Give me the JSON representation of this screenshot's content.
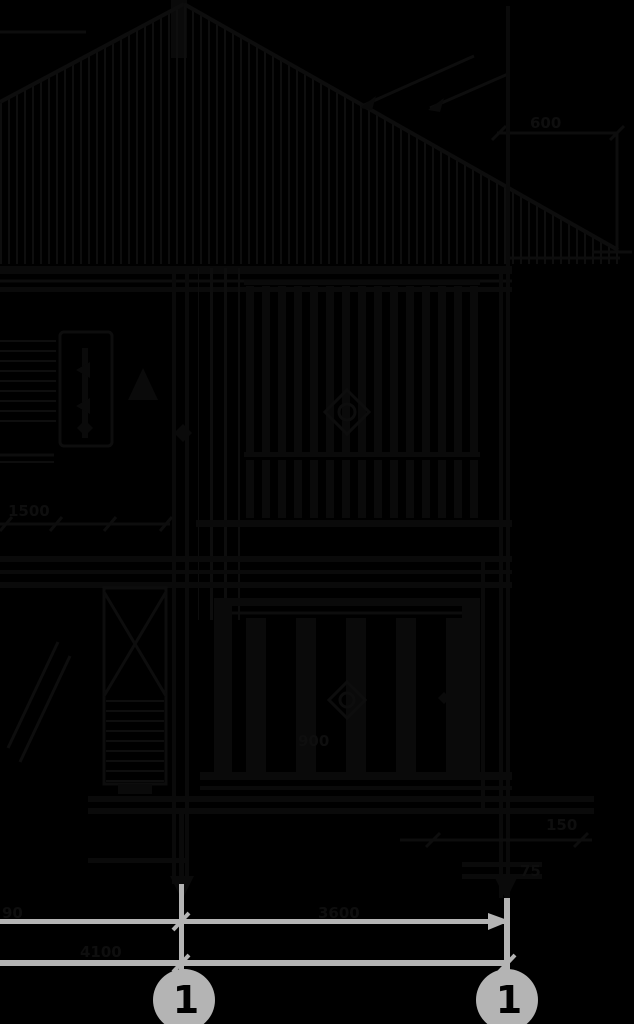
{
  "drawing": {
    "kind": "architectural-section-drawing",
    "colors": {
      "background": "#000000",
      "linework_dark": "#0d0d0d",
      "linework_light": "#b4b4b4",
      "bubble_fill": "#b4b4b4",
      "bubble_text": "#000000"
    },
    "axis_bubbles": [
      {
        "label": "1"
      },
      {
        "label": "1"
      }
    ],
    "dimensions": {
      "bottom_left": "90",
      "bottom_span": "3600",
      "bottom_lower": "4100",
      "top_right": "600",
      "mid_left": "1500",
      "right_upper": "150",
      "right_lower": "75",
      "railing": "900"
    }
  }
}
